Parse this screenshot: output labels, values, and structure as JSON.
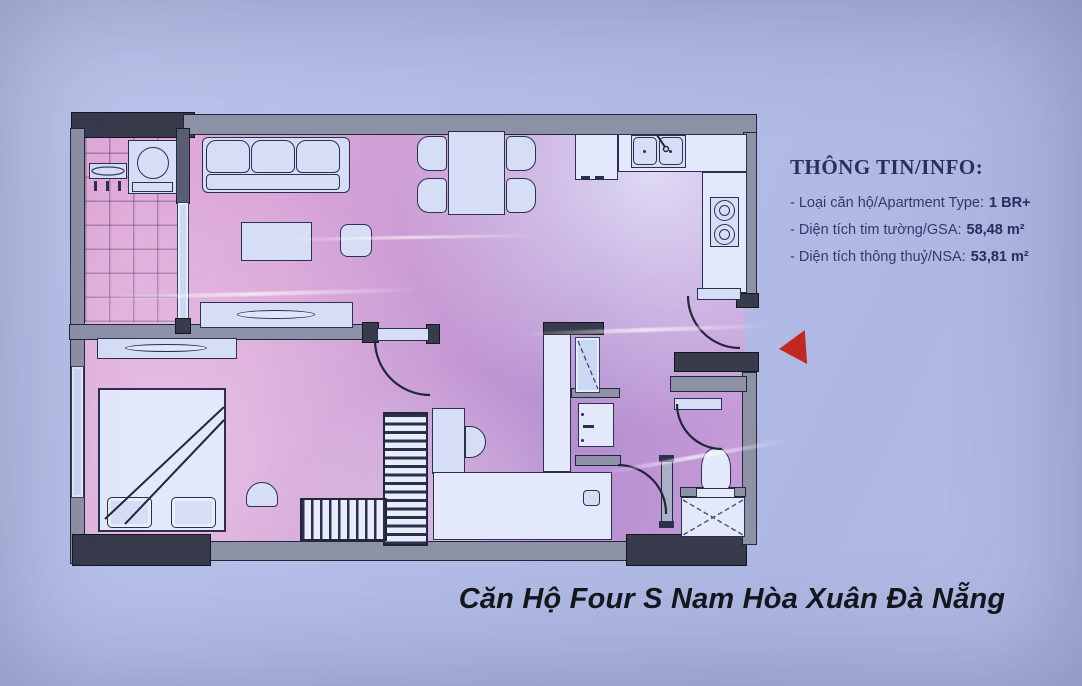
{
  "info_panel": {
    "heading": "THÔNG TIN/INFO:",
    "items": [
      {
        "label": "- Loại căn hộ/Apartment Type:",
        "value": "1 BR+"
      },
      {
        "label": "- Diện tích tim tường/GSA:",
        "value": "58,48 m²"
      },
      {
        "label": "- Diện tích thông thuỷ/NSA:",
        "value": "53,81 m²"
      }
    ]
  },
  "caption": "Căn Hộ Four S Nam Hòa Xuân Đà Nẵng",
  "floor_plan": {
    "rooms": [
      "balcony",
      "living-room",
      "dining-area",
      "kitchen",
      "bedroom",
      "bathroom",
      "wc",
      "hallway"
    ],
    "furniture": [
      "washing-machine",
      "drying-rack",
      "sofa",
      "coffee-table",
      "side-table",
      "tv-console",
      "dining-table",
      "dining-chairs",
      "fridge",
      "kitchen-sink",
      "stove",
      "double-bed",
      "pillows",
      "wardrobe",
      "hanging-wardrobe",
      "desk",
      "stool",
      "shoe-cabinet",
      "vanity-mirror",
      "bathroom-sink",
      "toilet",
      "shower-tray"
    ],
    "entrance_marker": "red-arrow-pointing-left"
  },
  "colors": {
    "background": "#b5bfe8",
    "floor_light": "#e2add9",
    "floor_dark": "#b48ed0",
    "wall_gray": "#8d92a6",
    "wall_dark": "#383b4c",
    "furniture_fill": "#d6def6",
    "outline": "#2c2f50",
    "glazing": "#c9d8f4",
    "arrow_red": "#c2281f",
    "heading_text": "#2b3156",
    "caption_text": "#15171d"
  }
}
